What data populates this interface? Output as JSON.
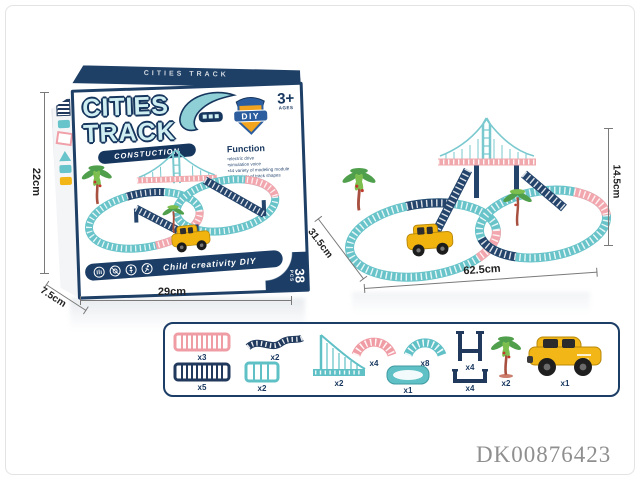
{
  "box": {
    "top_brand": "CITIES TRACK",
    "brand_line1": "CITIES",
    "brand_line2": "TRACK",
    "brand_sub": "CONSTUCTION",
    "badge_label": "DIY",
    "age_number": "3+",
    "age_label": "AGES",
    "function_title": "Function",
    "function_items": [
      "electric drive",
      "simulation voice",
      "44 variety of modeling module",
      "44 variety of track shapes"
    ],
    "banner_text": "Child creativity DIY",
    "pieces_count": "38",
    "pieces_unit": "PCS"
  },
  "dimensions": {
    "box_height": "22cm",
    "box_depth": "7.5cm",
    "box_width": "29cm",
    "set_height": "14.5cm",
    "set_depth": "31.5cm",
    "set_width": "62.5cm"
  },
  "parts": {
    "items": [
      {
        "name": "pink straight track",
        "qty": "x3"
      },
      {
        "name": "navy wave track",
        "qty": "x2"
      },
      {
        "name": "navy straight track",
        "qty": "x5"
      },
      {
        "name": "teal short track",
        "qty": "x2"
      },
      {
        "name": "suspension bridge",
        "qty": "x2"
      },
      {
        "name": "pink arc track",
        "qty": "x4"
      },
      {
        "name": "teal arc track",
        "qty": "x8"
      },
      {
        "name": "teal base plate",
        "qty": "x1"
      },
      {
        "name": "upper pillar bracket",
        "qty": "x4"
      },
      {
        "name": "lower pillar bracket",
        "qty": "x4"
      },
      {
        "name": "palm tree",
        "qty": "x2"
      },
      {
        "name": "toy car",
        "qty": "x1"
      }
    ]
  },
  "watermark": "DK00876423",
  "colors": {
    "navy": "#1c3e66",
    "teal": "#66c4ca",
    "pink": "#f2a6ad",
    "yellow": "#f2b616",
    "watermark_gray": "#8f8f8f"
  }
}
